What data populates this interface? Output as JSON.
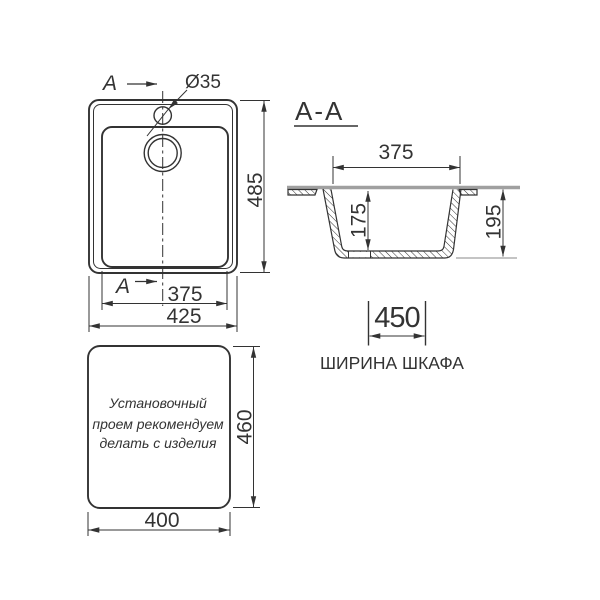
{
  "colors": {
    "line": "#333333",
    "countertop": "#a0a0a0",
    "bg": "#ffffff"
  },
  "top_view": {
    "section_letter": "A",
    "hole_diameter_label": "Ø35",
    "dim_height": "485",
    "dim_bowl_width": "375",
    "dim_overall_width": "425"
  },
  "section_view": {
    "title": "A-A",
    "dim_top_width": "375",
    "dim_depth": "175",
    "dim_height": "195"
  },
  "cabinet": {
    "dim_width": "450",
    "caption": "ШИРИНА ШКАФА"
  },
  "cutout_template": {
    "note_line1": "Установочный",
    "note_line2": "проем рекомендуем",
    "note_line3": "делать с изделия",
    "dim_height": "460",
    "dim_width": "400"
  }
}
